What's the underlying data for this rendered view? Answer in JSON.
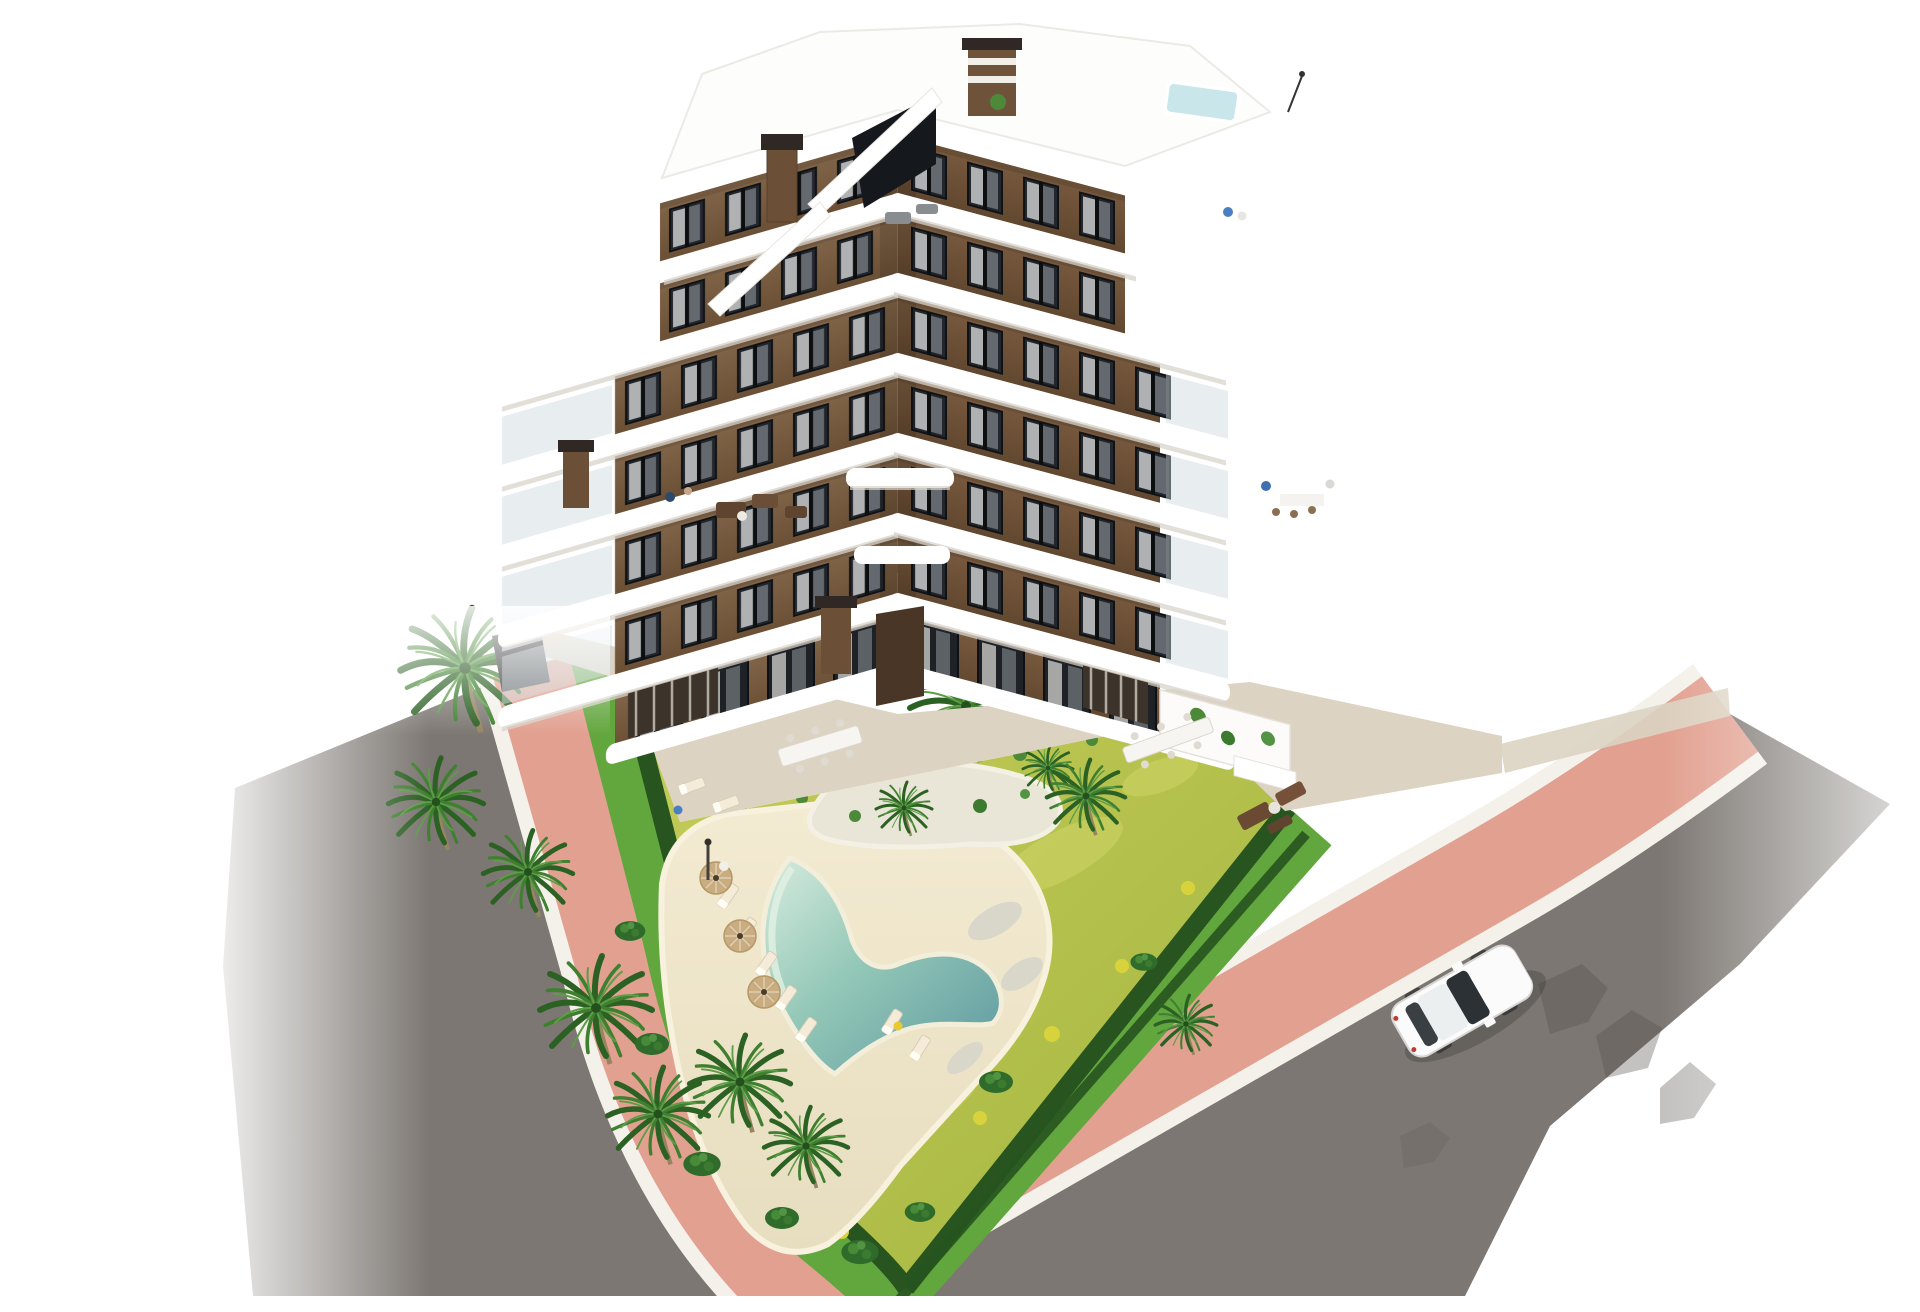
{
  "scene": {
    "kind": "aerial-architectural-render",
    "description": "Aerial 3D architectural render of a modern six-storey apartment building with curved white balcony slabs and brown facades, roof terraces with a small rooftop plunge pool, a landscaped corner garden containing palm trees and a heart-shaped swimming pool with sun loungers and parasols, all wrapped by a terracotta bike path and grey asphalt streets with a single white car driving by.",
    "building": {
      "storeys": 6,
      "facade_colors": [
        "brown",
        "white"
      ],
      "features": [
        "curved white balcony bands",
        "stepped roof terraces",
        "rooftop plunge pool",
        "stair bulkhead with dark glazing",
        "chimneys",
        "ground floor terraces with pergolas",
        "outdoor dining tables"
      ]
    },
    "garden": {
      "pool_shape": "heart",
      "palm_trees": 13,
      "sun_loungers": 9,
      "parasols": 3,
      "features": [
        "yellow-green lawn",
        "clipped hedges",
        "sand-coloured pool deck",
        "pebble beds",
        "island planting bed",
        "outdoor shower"
      ]
    },
    "street": {
      "roads": 2,
      "bike_path_color_name": "terracotta",
      "vehicles": [
        {
          "type": "car",
          "color": "white"
        }
      ]
    },
    "colors": {
      "background": "#ffffff",
      "asphalt": "#7c7772",
      "asphalt_shadow": "#57524e",
      "bike_path": "#e2a090",
      "curb": "#f4f1ea",
      "grass_strip": "#62a63e",
      "hedge": "#27541f",
      "lawn": "#b7c24f",
      "sand": "#efe6c9",
      "pebble": "#d9d6ca",
      "pool_shallow": "#d6ecdf",
      "pool_deep": "#5d98a0",
      "wall_brown": "#75593d",
      "wall_brown_dark": "#644931",
      "slab_white": "#ffffff",
      "slab_shadow": "#d8d3cb",
      "window_dark": "#23272d",
      "roof_pool": "#c9e6ea",
      "pavement": "#dcd3c2",
      "car_white": "#fbfbfb",
      "umbrella": "#c9ad80",
      "trunk": "#96855f"
    }
  }
}
